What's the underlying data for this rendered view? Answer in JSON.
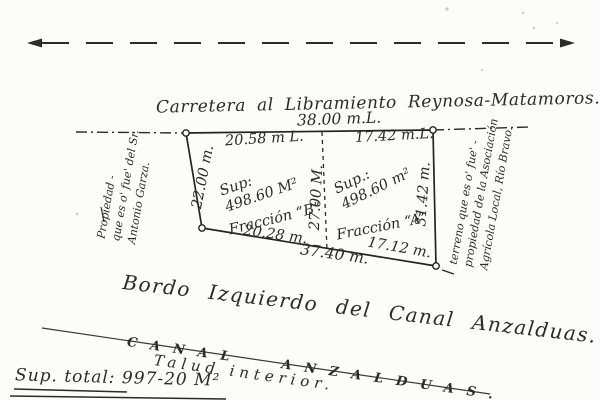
{
  "road": {
    "name": "Carretera al Libramiento Reynosa-Matamoros.",
    "frontage": "38.00 m.L."
  },
  "parcel": {
    "left_side": "22.00 m.",
    "divider": "27.00 M.",
    "right_side": "31.42 m.",
    "bottom_total": "37.40 m.",
    "fraction_b": {
      "top": "20.58 m L.",
      "sup_label": "Sup:",
      "area": "498.60 M²",
      "name": "Fracción “B”",
      "bottom": "20.28 m."
    },
    "fraction_a": {
      "top": "17.42 m.L.",
      "sup_label": "Sup.:",
      "area": "498.60 m²",
      "name": "Fracción “A”",
      "bottom": "17.12 m."
    }
  },
  "neighbors": {
    "west": {
      "line1": "Propiedad -",
      "line2": "que es o' fue' del Sr.",
      "line3": "Antonio Garza."
    },
    "east": {
      "line1": "terreno que es o' fue' -",
      "line2": "propiedad de la Asociación",
      "line3": "Agrícola Local, Río Bravo."
    }
  },
  "canal": {
    "bordo": "Bordo Izquierdo del Canal Anzalduas.",
    "name": "CANAL ANZALDUAS.",
    "talud": "Talud interior."
  },
  "totals": {
    "label": "Sup. total:",
    "value": "997-20 M²"
  },
  "colors": {
    "ink": "#2b2b2b",
    "paper": "#fcfcfa"
  }
}
